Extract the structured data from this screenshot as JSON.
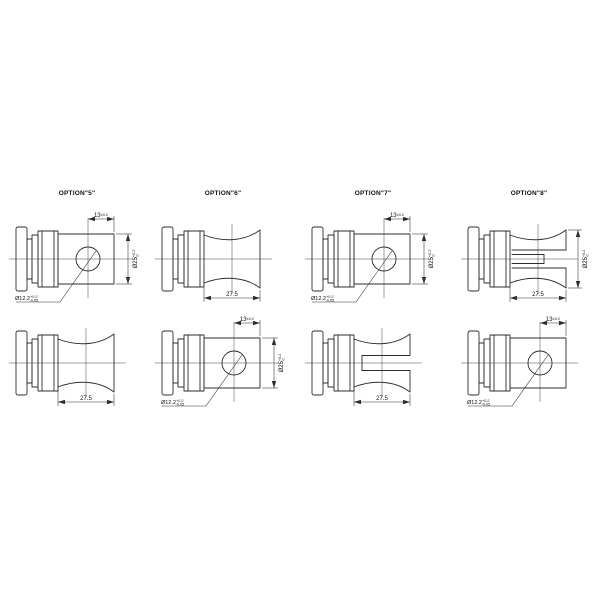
{
  "page": {
    "background": "#ffffff",
    "line_color": "#2d2d2d"
  },
  "options": [
    {
      "label": "OPTION\"5\""
    },
    {
      "label": "OPTION\"6\""
    },
    {
      "label": "OPTION\"7\""
    },
    {
      "label": "OPTION\"8\""
    }
  ],
  "dims": {
    "hole_offset": {
      "value": "13",
      "tol": "±0.2"
    },
    "outer_dia": {
      "value": "Ø25",
      "tol_up": "+0.2",
      "tol_dn": "0"
    },
    "hole_dia": {
      "value": "Ø12.2",
      "tol_up": "+0.2",
      "tol_dn": "-0.05"
    },
    "body_width": {
      "value": "27.5"
    }
  }
}
